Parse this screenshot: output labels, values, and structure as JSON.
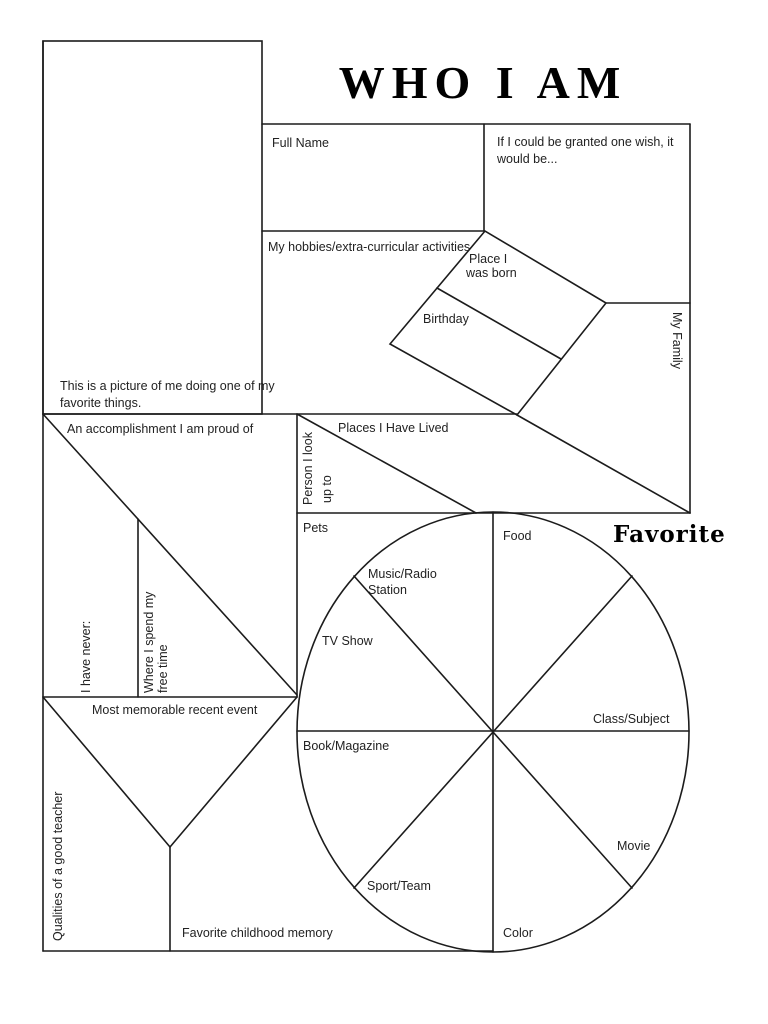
{
  "title": "WHO I AM",
  "sections": {
    "picture_caption": {
      "line1": "This is a picture of me doing one of my",
      "line2": "favorite things."
    },
    "full_name": "Full Name",
    "wish": {
      "line1": "If I could be granted one wish, it",
      "line2": "would be..."
    },
    "hobbies": "My hobbies/extra-curricular activities",
    "place_born": {
      "line1": "Place  I",
      "line2": "was born"
    },
    "birthday": "Birthday",
    "my_family": "My Family",
    "accomplishment": "An accomplishment I am proud of",
    "person_look_up_to": {
      "line1": "Person I look",
      "line2": "up to"
    },
    "places_lived": "Places I Have Lived",
    "i_have_never": "I have never:",
    "free_time": {
      "line1": "Where I spend my",
      "line2": "free time"
    },
    "memorable_event": "Most memorable recent event",
    "qualities_teacher": "Qualities of a good teacher",
    "childhood_memory": "Favorite childhood memory"
  },
  "favorites_wheel": {
    "heading": "Favorite",
    "pets": "Pets",
    "food": "Food",
    "music": {
      "line1": "Music/Radio",
      "line2": "Station"
    },
    "tv_show": "TV Show",
    "class_subject": "Class/Subject",
    "book_magazine": "Book/Magazine",
    "movie": "Movie",
    "sport_team": "Sport/Team",
    "color": "Color"
  },
  "colors": {
    "ink": "#1c1c1c",
    "paper": "#ffffff"
  }
}
